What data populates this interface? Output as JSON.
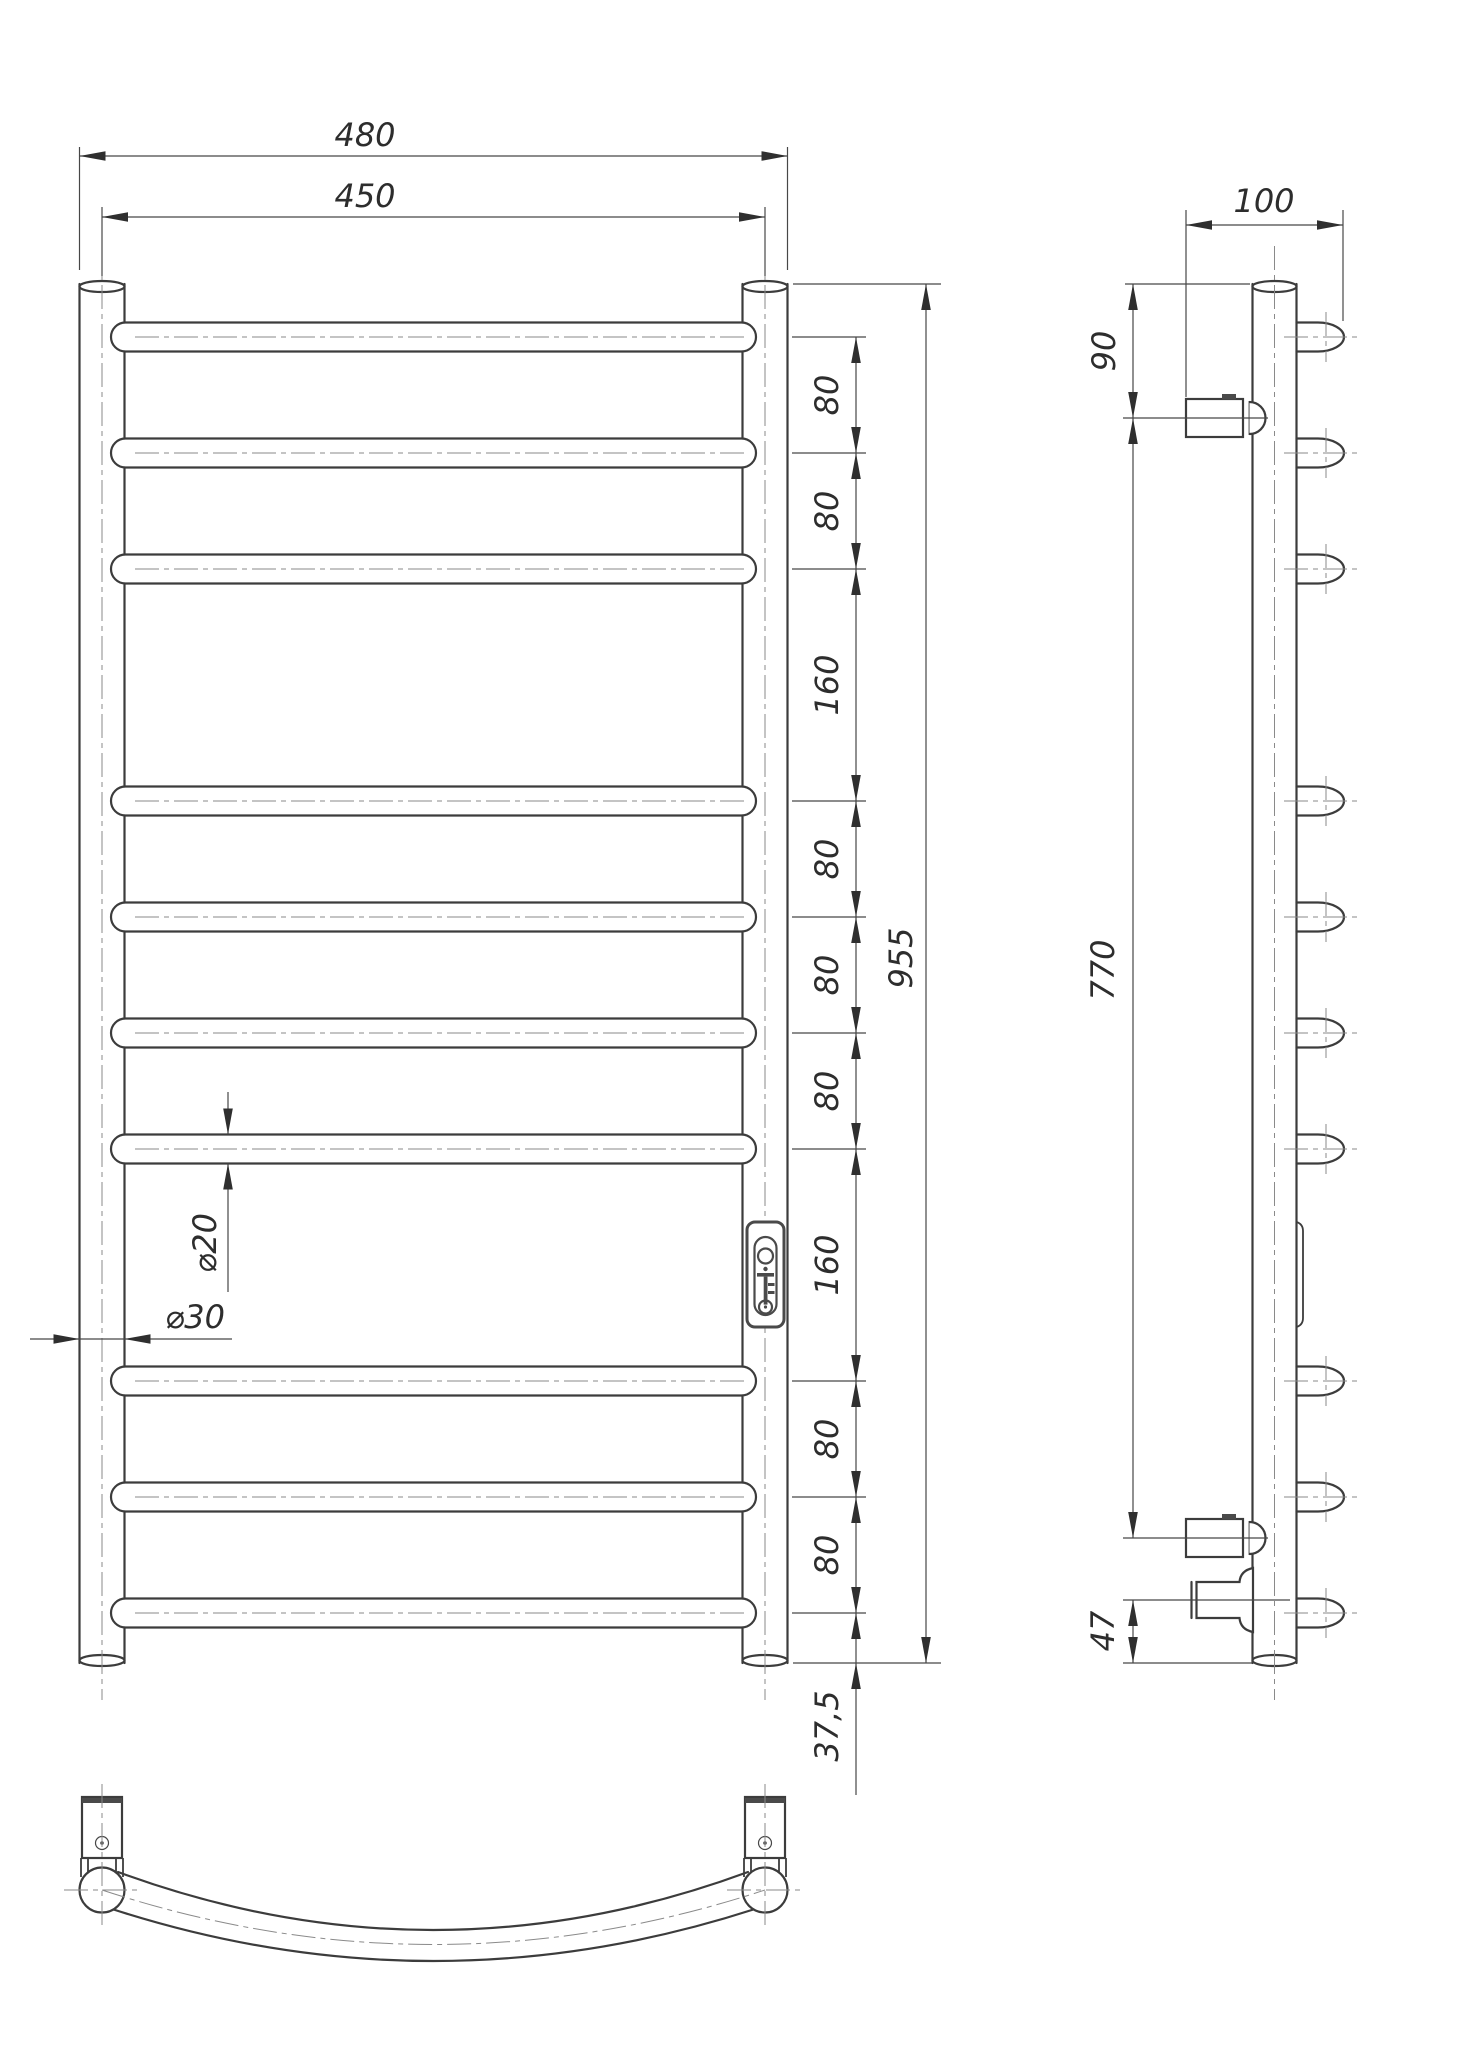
{
  "page": {
    "background": "#ffffff"
  },
  "drawing": {
    "type": "technical-drawing",
    "subject": "ladder-towel-rail",
    "brand": "Mario",
    "colors": {
      "outline": "#3c3c3c",
      "thin_line": "#474747",
      "centerline": "#8a8a8a",
      "text": "#2d2d2d"
    },
    "front_view": {
      "rung_count": 10,
      "dim_width_overall": "480",
      "dim_width_centers": "450",
      "dim_height_overall": "955",
      "dim_bottom_offset": "37,5",
      "rung_spacing": [
        "80",
        "80",
        "160",
        "80",
        "80",
        "80",
        "160",
        "80",
        "80"
      ],
      "dim_rung_diameter": "⌀20",
      "dim_tube_diameter": "⌀30"
    },
    "side_view": {
      "dim_depth": "100",
      "dim_top_bracket_offset": "90",
      "dim_bracket_span": "770",
      "dim_connector_offset": "47"
    }
  }
}
